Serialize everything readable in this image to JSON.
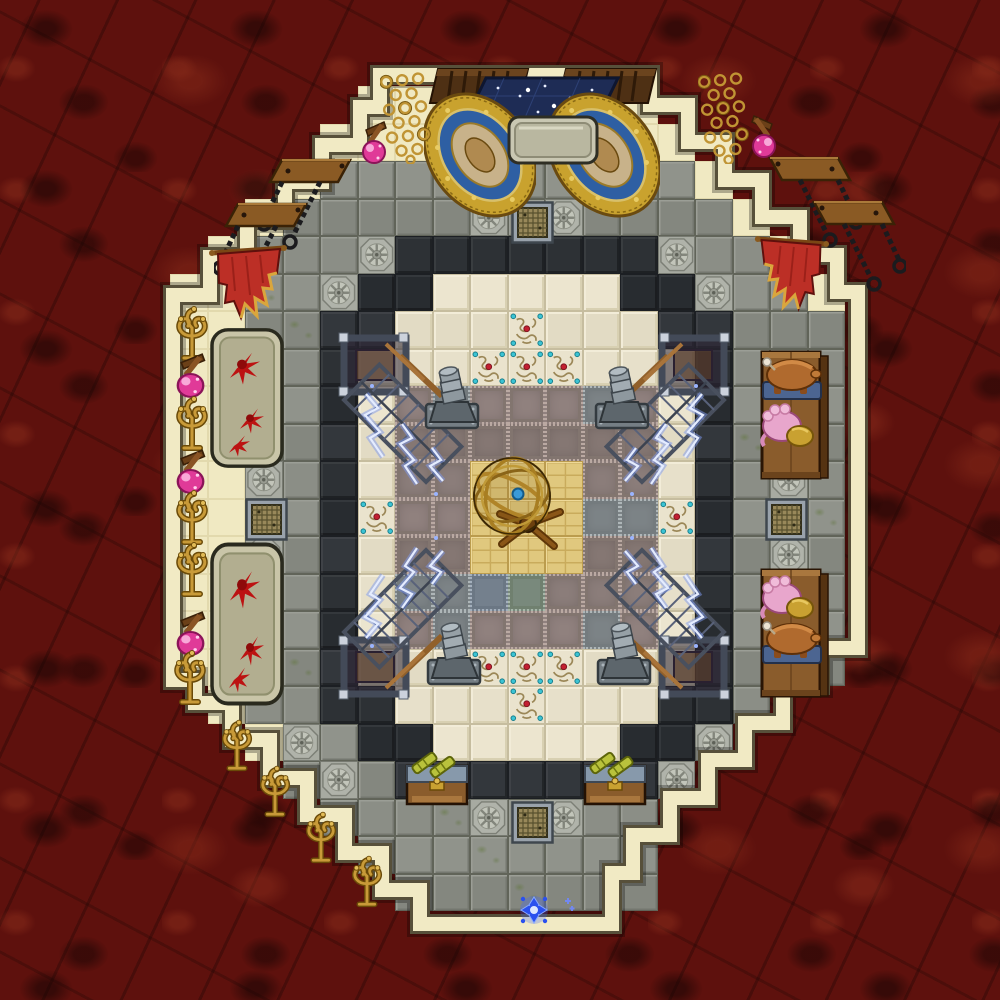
{
  "colors": {
    "lava": "#5e110d",
    "wall_cream": "#f1eac4",
    "wall_outline": "#57503a",
    "stone_gray": "#8b8e86",
    "dark_tile": "#2d3135",
    "marble": "#e7e0ca",
    "metal_plate_mauve": "#8b7d7a",
    "steel_plate": "#7c8386",
    "blue_steel": "#74808d",
    "green_steel": "#79897c",
    "sand_brick": "#e0c87e",
    "gold": "#c89a38",
    "lightning_blue": "#cfe0ff",
    "banner_red": "#bc2f26",
    "carpet_navy": "#1e2c55",
    "rug_gold": "#c9a22e",
    "blood_red": "#bc1212",
    "rune_blue": "#2a50ee",
    "torch_orb_pink": "#e03a98"
  },
  "grid": {
    "tile_size": 37.5,
    "origin_x": 20,
    "origin_y": 11,
    "cols": 26,
    "rows": 26
  },
  "legend": {
    "G": "stone-floor-tile",
    "K": "dark-floor-tile",
    "M": "marble-floor-tile",
    "F": "walkway-tile",
    "P": "riveted-plate-tile",
    "S": "steel-plate-tile",
    "B": "blue-steel-tile",
    "N": "green-steel-tile",
    "D": "sand-brick-tile",
    "R": "rosette-tile",
    "Y": "glyph-tile",
    ".": "empty"
  },
  "tilemap": [
    "..........................",
    "..........................",
    ".........FFFFFFFF.........",
    "........FFFFFFFFFF........",
    ".......FGGGGGGGGGGF.......",
    "......FGGGGGRGRGGGGF......",
    ".....FGGGRKKKKKKKRGGF.....",
    "....FFGGRKKMMMMMKKRGGF....",
    "....FFGGKKMMMYMMMKKGGG....",
    "....FFGGKMMMYYYMMMKGGG....",
    "....FFGGKMPSPPPSPMKGGG....",
    "....FFGGKMPPPPPPPMKGGG....",
    "....FFRGKMPPDDDPPMKGRG....",
    "....FFGGKYPPDDDSSYKGGG....",
    "....FFRGKMPPDDDPPMKGRG....",
    "....FFGGKMSSBNPPPMKGGG....",
    "....FFGGKMPSPPPSPMKGGG....",
    "....FFGGKMMMYYYMMMKGGG....",
    ".....FGGKKMMMYMMMKKG......",
    "......FRGKKMMMMMKKR.......",
    ".......GRGKKKKKKKR........",
    "........GGGGRGRGG.........",
    ".........GGGGGGGG.........",
    "..........GGGGGGG.........",
    "..........................",
    ".........................."
  ],
  "wall": {
    "path": "M380 75H650V105H688V142H725V180H762V217H800V255H837V292H858V648H820V685H783V723H745V760H708V798H670V835H633V873H612V924H420V890H382V853H345V815H307V778H270V740H232V703H195V680H173V295H210V257H247V220H285V182H322V145H360V107H380Z"
  },
  "items": [
    {
      "type": "grate",
      "name": "sewer-grate-north",
      "x": 511,
      "y": 201,
      "w": 43,
      "h": 43
    },
    {
      "type": "grate",
      "name": "sewer-grate-west",
      "x": 245,
      "y": 498,
      "w": 43,
      "h": 43
    },
    {
      "type": "grate",
      "name": "sewer-grate-east",
      "x": 765,
      "y": 498,
      "w": 43,
      "h": 43
    },
    {
      "type": "grate",
      "name": "sewer-grate-south",
      "x": 511,
      "y": 801,
      "w": 43,
      "h": 43
    },
    {
      "type": "trough",
      "name": "blood-trough-upper",
      "x": 208,
      "y": 326,
      "w": 78,
      "h": 144
    },
    {
      "type": "trough",
      "name": "blood-trough-lower",
      "x": 208,
      "y": 540,
      "w": 78,
      "h": 168
    },
    {
      "type": "cabinet",
      "name": "cabinet-left",
      "x": 428,
      "y": 66,
      "w": 102,
      "h": 40
    },
    {
      "type": "cabinet",
      "name": "cabinet-right",
      "x": 556,
      "y": 66,
      "w": 102,
      "h": 40
    },
    {
      "type": "celestial-carpet",
      "name": "celestial-carpet",
      "x": 450,
      "y": 76,
      "w": 170,
      "h": 74
    },
    {
      "type": "rug",
      "name": "ornate-rug-left",
      "x": 424,
      "y": 84,
      "w": 112,
      "h": 142
    },
    {
      "type": "rug",
      "name": "ornate-rug-right",
      "x": 548,
      "y": 84,
      "w": 112,
      "h": 142
    },
    {
      "type": "chain-rack",
      "name": "chainmail-rack-left",
      "x": 380,
      "y": 70,
      "w": 52,
      "h": 94
    },
    {
      "type": "chain-rack",
      "name": "chainmail-rack-right",
      "x": 698,
      "y": 70,
      "w": 52,
      "h": 94
    },
    {
      "type": "altar",
      "name": "stone-altar",
      "x": 505,
      "y": 113,
      "w": 96,
      "h": 54
    },
    {
      "type": "torch",
      "name": "wall-torch-nw",
      "x": 358,
      "y": 116,
      "w": 38,
      "h": 50
    },
    {
      "type": "torch",
      "name": "wall-torch-ne",
      "x": 742,
      "y": 110,
      "w": 38,
      "h": 50,
      "flip": "x"
    },
    {
      "type": "plaque",
      "name": "chain-plaque-nw-1",
      "x": 258,
      "y": 156,
      "w": 94,
      "h": 94
    },
    {
      "type": "plaque",
      "name": "chain-plaque-nw-2",
      "x": 214,
      "y": 200,
      "w": 94,
      "h": 94
    },
    {
      "type": "plaque",
      "name": "chain-plaque-ne-1",
      "x": 768,
      "y": 154,
      "w": 94,
      "h": 94,
      "flip": "x"
    },
    {
      "type": "plaque",
      "name": "chain-plaque-ne-2",
      "x": 812,
      "y": 198,
      "w": 94,
      "h": 94,
      "flip": "x"
    },
    {
      "type": "banner",
      "name": "red-banner-nw",
      "x": 208,
      "y": 243,
      "w": 82,
      "h": 94
    },
    {
      "type": "banner",
      "name": "red-banner-ne",
      "x": 752,
      "y": 234,
      "w": 78,
      "h": 94,
      "flip": "x"
    },
    {
      "type": "candelabra",
      "name": "gold-candelabra-w1",
      "x": 170,
      "y": 302,
      "w": 44,
      "h": 60
    },
    {
      "type": "torch",
      "name": "wall-torch-w1",
      "x": 172,
      "y": 348,
      "w": 44,
      "h": 52
    },
    {
      "type": "candelabra",
      "name": "gold-candelabra-w2",
      "x": 170,
      "y": 392,
      "w": 44,
      "h": 60
    },
    {
      "type": "torch",
      "name": "wall-torch-w2",
      "x": 172,
      "y": 444,
      "w": 44,
      "h": 52
    },
    {
      "type": "candelabra",
      "name": "gold-candelabra-w3",
      "x": 170,
      "y": 486,
      "w": 44,
      "h": 60
    },
    {
      "type": "candelabra",
      "name": "gold-candelabra-w4",
      "x": 170,
      "y": 538,
      "w": 44,
      "h": 60
    },
    {
      "type": "torch",
      "name": "wall-torch-w3",
      "x": 172,
      "y": 606,
      "w": 44,
      "h": 52
    },
    {
      "type": "candelabra",
      "name": "gold-candelabra-w5",
      "x": 168,
      "y": 646,
      "w": 44,
      "h": 60
    },
    {
      "type": "candelabra",
      "name": "gold-candelabra-sw1",
      "x": 216,
      "y": 716,
      "w": 42,
      "h": 56
    },
    {
      "type": "candelabra",
      "name": "gold-candelabra-sw2",
      "x": 254,
      "y": 762,
      "w": 42,
      "h": 56
    },
    {
      "type": "candelabra",
      "name": "gold-candelabra-sw3",
      "x": 300,
      "y": 808,
      "w": 42,
      "h": 56
    },
    {
      "type": "candelabra",
      "name": "gold-candelabra-sw4",
      "x": 346,
      "y": 852,
      "w": 42,
      "h": 56
    },
    {
      "type": "cage",
      "name": "lightning-cage-nw",
      "x": 336,
      "y": 328,
      "w": 142,
      "h": 184
    },
    {
      "type": "cage",
      "name": "lightning-cage-ne",
      "x": 590,
      "y": 328,
      "w": 142,
      "h": 184,
      "flip": "x"
    },
    {
      "type": "cage",
      "name": "lightning-cage-sw",
      "x": 336,
      "y": 520,
      "w": 142,
      "h": 184,
      "flip": "y"
    },
    {
      "type": "cage",
      "name": "lightning-cage-se",
      "x": 590,
      "y": 520,
      "w": 142,
      "h": 184,
      "flip": "xy"
    },
    {
      "type": "bollard",
      "name": "machine-bollard-nw",
      "x": 424,
      "y": 366,
      "w": 56,
      "h": 66
    },
    {
      "type": "bollard",
      "name": "machine-bollard-ne",
      "x": 594,
      "y": 366,
      "w": 56,
      "h": 66
    },
    {
      "type": "bollard",
      "name": "machine-bollard-sw",
      "x": 426,
      "y": 622,
      "w": 56,
      "h": 66
    },
    {
      "type": "bollard",
      "name": "machine-bollard-se",
      "x": 596,
      "y": 622,
      "w": 56,
      "h": 66
    },
    {
      "type": "table-e",
      "name": "wooden-table-east-1",
      "x": 758,
      "y": 350,
      "w": 74,
      "h": 134
    },
    {
      "type": "pig",
      "name": "roast-animal-e1",
      "x": 760,
      "y": 354,
      "w": 64,
      "h": 52
    },
    {
      "type": "pink",
      "name": "pink-creature-e1",
      "x": 758,
      "y": 402,
      "w": 58,
      "h": 50
    },
    {
      "type": "table-e",
      "name": "wooden-table-east-2",
      "x": 758,
      "y": 568,
      "w": 74,
      "h": 134
    },
    {
      "type": "pink",
      "name": "pink-creature-e2",
      "x": 758,
      "y": 574,
      "w": 58,
      "h": 50
    },
    {
      "type": "pig",
      "name": "roast-animal-e2",
      "x": 760,
      "y": 618,
      "w": 64,
      "h": 52
    },
    {
      "type": "table-s",
      "name": "telescope-table-sw",
      "x": 404,
      "y": 748,
      "w": 66,
      "h": 60
    },
    {
      "type": "table-s",
      "name": "telescope-table-se",
      "x": 582,
      "y": 748,
      "w": 66,
      "h": 60
    },
    {
      "type": "armillary",
      "name": "armillary-sphere",
      "x": 466,
      "y": 450,
      "w": 104,
      "h": 104
    },
    {
      "type": "rune",
      "name": "blue-rune-field",
      "x": 518,
      "y": 894,
      "w": 32,
      "h": 32
    },
    {
      "type": "sparkle",
      "name": "blue-sparkle",
      "x": 560,
      "y": 896,
      "w": 16,
      "h": 20
    }
  ]
}
